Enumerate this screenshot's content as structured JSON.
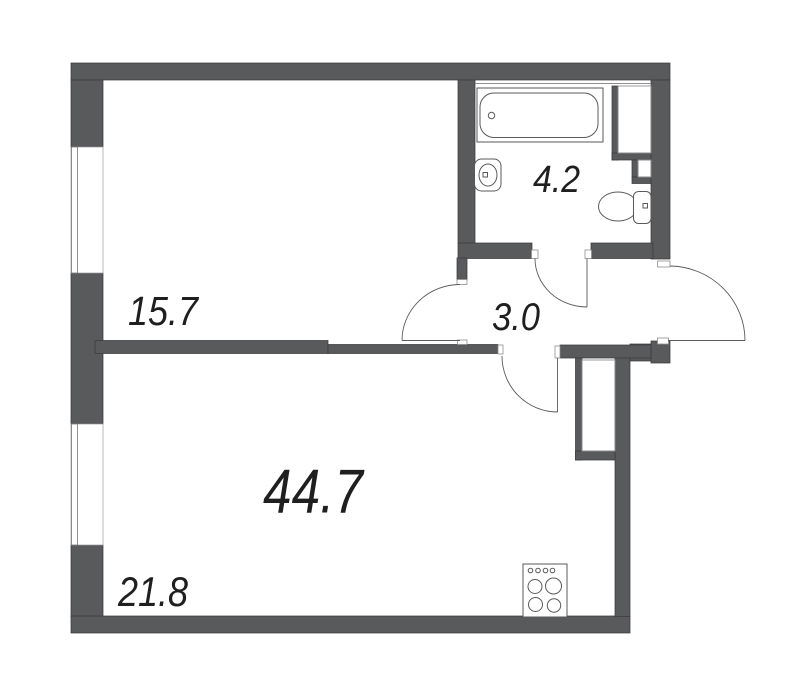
{
  "page": {
    "background": "#ffffff"
  },
  "floorplan": {
    "total_area": "44.7",
    "rooms": [
      {
        "name": "living-room",
        "area": "15.7"
      },
      {
        "name": "bathroom",
        "area": "4.2"
      },
      {
        "name": "hallway",
        "area": "3.0"
      },
      {
        "name": "kitchen-living-area",
        "area": "21.8"
      }
    ],
    "fixtures": [
      {
        "icon": "bathtub-icon"
      },
      {
        "icon": "sink-icon"
      },
      {
        "icon": "toilet-icon"
      },
      {
        "icon": "stove-icon"
      }
    ],
    "doors": [
      {
        "icon": "door-arc",
        "location": "bathroom"
      },
      {
        "icon": "door-arc",
        "location": "living-room"
      },
      {
        "icon": "door-arc",
        "location": "kitchen-living-area"
      },
      {
        "icon": "door-arc",
        "location": "entrance"
      }
    ],
    "windows": [
      {
        "icon": "window",
        "location": "living-room"
      },
      {
        "icon": "window",
        "location": "kitchen-living-area"
      }
    ],
    "colors": {
      "wall": "#595a5c",
      "wall_outline": "#3c3d3f",
      "fixture_line": "#5a5a5a",
      "thin_line": "#8f8f8f",
      "text": "#1f1f1f"
    }
  }
}
